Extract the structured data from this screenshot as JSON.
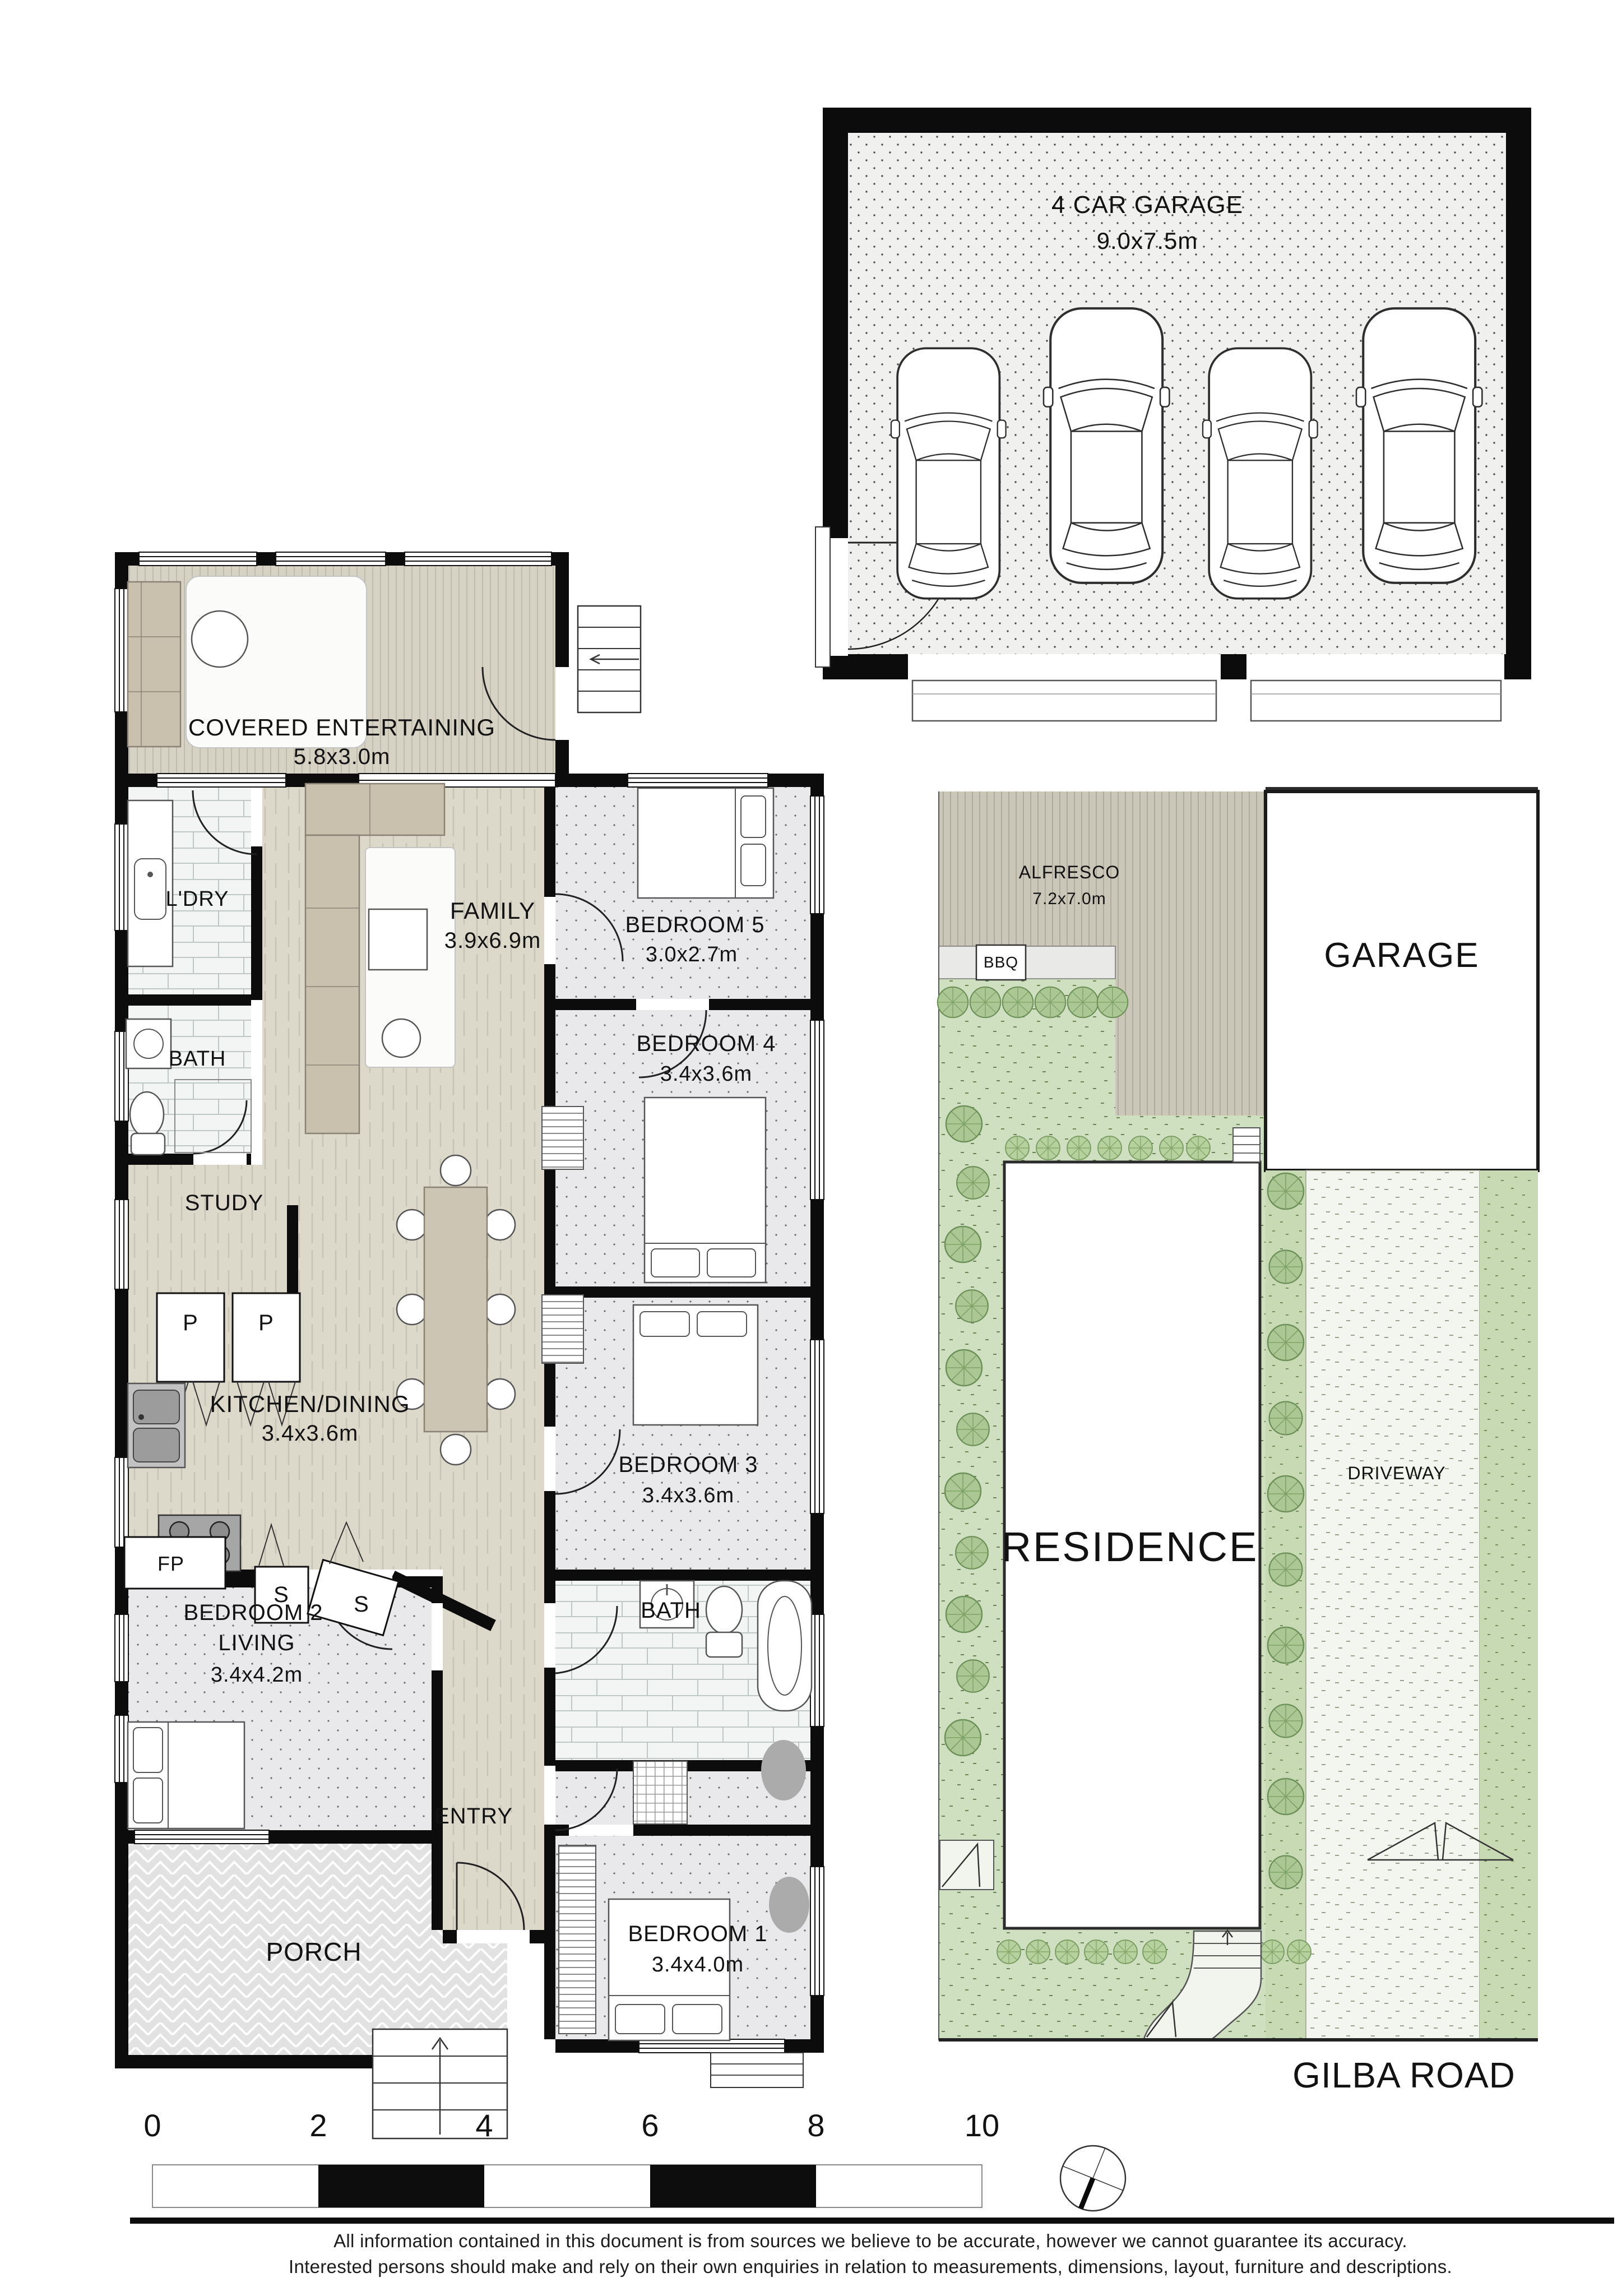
{
  "garage_plan": {
    "title": "4 CAR GARAGE",
    "dims": "9.0x7.5m"
  },
  "house": {
    "covered_entertaining": {
      "name": "COVERED ENTERTAINING",
      "dims": "5.8x3.0m"
    },
    "laundry": {
      "name": "L'DRY"
    },
    "family": {
      "name": "FAMILY",
      "dims": "3.9x6.9m"
    },
    "bedroom5": {
      "name": "BEDROOM 5",
      "dims": "3.0x2.7m"
    },
    "bath_top": {
      "name": "BATH"
    },
    "bedroom4": {
      "name": "BEDROOM 4",
      "dims": "3.4x3.6m"
    },
    "study": {
      "name": "STUDY"
    },
    "pantry": [
      "P",
      "P"
    ],
    "kitchen_dining": {
      "name": "KITCHEN/DINING",
      "dims": "3.4x3.6m"
    },
    "bedroom3": {
      "name": "BEDROOM 3",
      "dims": "3.4x3.6m"
    },
    "cupboards": [
      "S",
      "S"
    ],
    "fireplace": {
      "name": "FP"
    },
    "bedroom2": {
      "line1": "BEDROOM 2",
      "line2": "LIVING",
      "dims": "3.4x4.2m"
    },
    "bath_bottom": {
      "name": "BATH"
    },
    "entry": {
      "name": "ENTRY"
    },
    "bedroom1": {
      "name": "BEDROOM 1",
      "dims": "3.4x4.0m"
    },
    "porch": {
      "name": "PORCH"
    }
  },
  "site": {
    "alfresco": {
      "name": "ALFRESCO",
      "dims": "7.2x7.0m"
    },
    "bbq": {
      "name": "BBQ"
    },
    "garage": {
      "name": "GARAGE"
    },
    "residence": {
      "name": "RESIDENCE"
    },
    "driveway": {
      "name": "DRIVEWAY"
    },
    "road": {
      "name": "GILBA ROAD"
    }
  },
  "scale_bar": {
    "ticks": [
      "0",
      "2",
      "4",
      "6",
      "8",
      "10"
    ]
  },
  "compass": {
    "icon": "compass-needle-icon"
  },
  "disclaimer": {
    "line1": "All information contained in this document is from sources we believe to be accurate, however we cannot guarantee its accuracy.",
    "line2": "Interested persons should make and rely on their own enquiries in relation to measurements, dimensions, layout, furniture and descriptions."
  },
  "colors": {
    "wall": "#0c0c0c",
    "deck": "#d6d2c4",
    "alfresco_deck": "#cac6b8",
    "wood_floor": "#dcd8ca",
    "carpet": "#e9e9ec",
    "tile": "#f3f5f5",
    "garage_floor": "#f0f0ef",
    "porch": "#e2e2e2",
    "lawn": "#cfe0c0",
    "driveway": "#f3f5ef",
    "tree": "#abc894"
  }
}
